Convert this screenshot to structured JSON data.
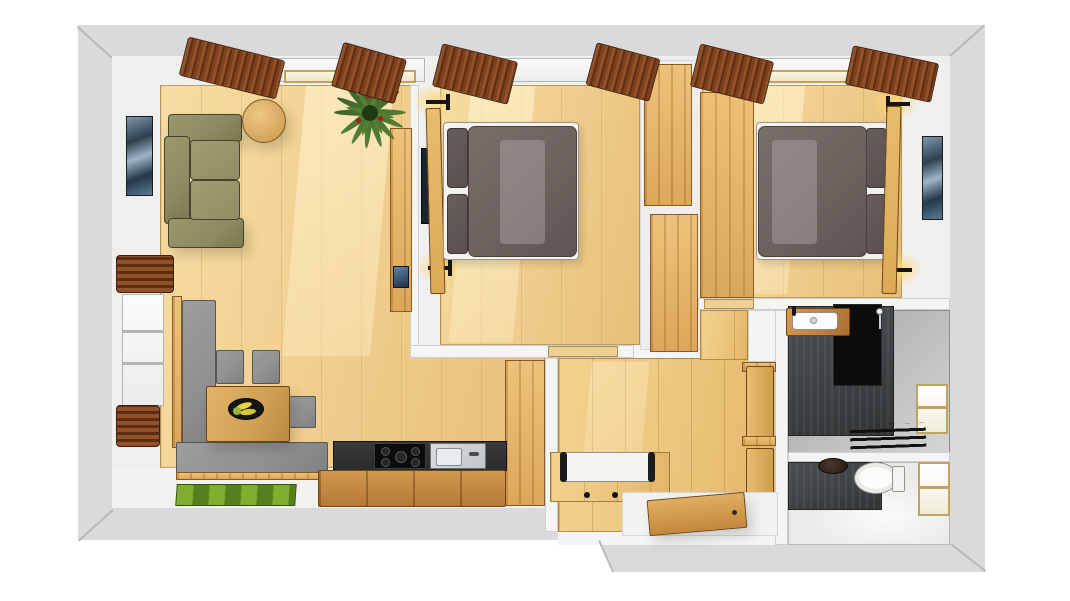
{
  "scene": {
    "type": "3d-floorplan-render",
    "view": "top-down-dollhouse",
    "rendered_text": ""
  },
  "palette": {
    "wall_outer": "#dadadc",
    "wall_line": "#97979a",
    "wall_inner": "#f4f4f2",
    "wall_face": "#efefed",
    "floor_wood": "#f1cf90",
    "floor_hall": "#ecc77e",
    "sofa": "#8d8a62",
    "sofa_line": "#45422d",
    "bench": "#8f9092",
    "cushion_white": "#f5f4f0",
    "duvet": "#6e625f",
    "duvet_hi": "#8d8280",
    "pillow": "#5a4f4e",
    "sheet": "#f4f2ee",
    "headboard": "#dcaa57",
    "curtain": "#8a4a26",
    "curtain_dark": "#5e2e12",
    "art_blue": "#3a5068",
    "plant": "#3c6628",
    "plant_hi": "#557f35",
    "berry": "#a81d18",
    "wood_cab": "#c08442",
    "wood_edge": "#6f4514",
    "counter": "#2b2b2b",
    "steel": "#c3c6c8",
    "tile": "#404345",
    "tile_black": "#0c0c0c",
    "bath_floor": "#b8baba",
    "wc_floor": "#eaeae8",
    "mat": "#7fae2f",
    "mat_dark": "#567f1d",
    "glow": "#ffd878",
    "tv_dark": "#1a2430",
    "white": "#ffffff"
  },
  "rooms": {
    "living_room": {
      "label": "living-room",
      "items": [
        "sofa",
        "coffee-table",
        "potted-plant",
        "wall-art",
        "sideboard",
        "window-with-blinds",
        "curtains"
      ]
    },
    "dining_area": {
      "label": "dining-area",
      "items": [
        "corner-bench",
        "dining-table",
        "fruit-bowl",
        "chair",
        "chair",
        "chair"
      ]
    },
    "kitchen": {
      "label": "kitchen",
      "items": [
        "dark-worktop",
        "cooktop",
        "sink",
        "base-cabinets",
        "tall-cabinet",
        "green-door-mat"
      ]
    },
    "bedroom_1": {
      "label": "bedroom-1",
      "items": [
        "double-bed",
        "duvet",
        "pillows",
        "headboard",
        "wall-lamp",
        "wall-lamp",
        "wardrobe",
        "tv",
        "curtains"
      ]
    },
    "bedroom_2": {
      "label": "bedroom-2",
      "items": [
        "double-bed",
        "duvet",
        "pillows",
        "headboard",
        "wall-lamp",
        "wall-lamp",
        "wardrobe",
        "wall-art",
        "curtains"
      ]
    },
    "hallway": {
      "label": "hallway",
      "items": [
        "bench-with-cushion",
        "coat-hooks",
        "entrance-door-open",
        "bathroom-door-open",
        "wc-door-open"
      ]
    },
    "bathroom": {
      "label": "bathroom",
      "items": [
        "washbasin-counter",
        "dark-tile-walls",
        "shower-panel",
        "floor-drain-grate",
        "window"
      ]
    },
    "wc": {
      "label": "wc",
      "items": [
        "toilet",
        "dark-vessel-basin",
        "dark-tile-wall",
        "window"
      ]
    }
  }
}
